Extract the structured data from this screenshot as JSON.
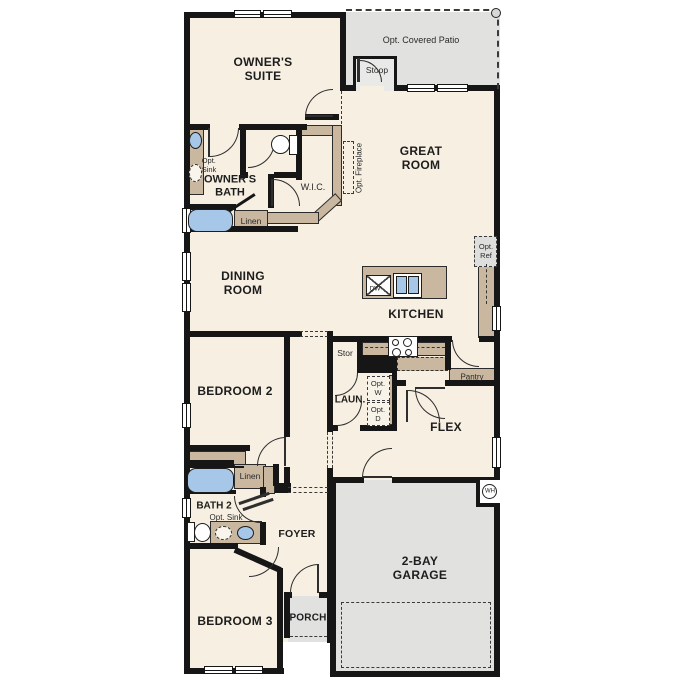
{
  "floorplan": {
    "rooms": {
      "owners_suite": {
        "line1": "OWNER'S",
        "line2": "SUITE"
      },
      "covered_patio": {
        "label": "Opt. Covered Patio"
      },
      "stoop": {
        "label": "Stoop"
      },
      "great_room": {
        "line1": "GREAT",
        "line2": "ROOM"
      },
      "owners_bath": {
        "line1": "OWNER'S",
        "line2": "BATH"
      },
      "wic": {
        "label": "W.I.C."
      },
      "dining_room": {
        "line1": "DINING",
        "line2": "ROOM"
      },
      "kitchen": {
        "label": "KITCHEN"
      },
      "bedroom_2": {
        "label": "BEDROOM 2"
      },
      "laundry": {
        "label": "LAUN."
      },
      "flex": {
        "label": "FLEX"
      },
      "bath_2": {
        "label": "BATH 2"
      },
      "foyer": {
        "label": "FOYER"
      },
      "bedroom_3": {
        "label": "BEDROOM 3"
      },
      "porch": {
        "label": "PORCH"
      },
      "garage": {
        "line1": "2-BAY",
        "line2": "GARAGE"
      }
    },
    "closets": {
      "linen_upper": {
        "label": "Linen"
      },
      "linen_lower": {
        "label": "Linen"
      },
      "storage": {
        "label": "Stor"
      },
      "pantry": {
        "label": "Pantry"
      }
    },
    "options": {
      "fireplace": {
        "label": "Opt. Fireplace"
      },
      "sink_owners_bath": {
        "line1": "Opt.",
        "line2": "Sink"
      },
      "sink_bath_2": {
        "label": "Opt. Sink"
      },
      "refrigerator": {
        "line1": "Opt.",
        "line2": "Ref"
      },
      "washer": {
        "line1": "Opt.",
        "line2": "W"
      },
      "dryer": {
        "line1": "Opt.",
        "line2": "D"
      }
    },
    "appliances": {
      "dishwasher": {
        "label": "DW"
      },
      "water_heater": {
        "label": "WH"
      }
    },
    "colors": {
      "floor": "#f6efe2",
      "hardscape": "#e1e1e0",
      "wall": "#161616",
      "cabinetry": "#c9b7a0",
      "fixture_blue": "#a6c7e7"
    }
  }
}
